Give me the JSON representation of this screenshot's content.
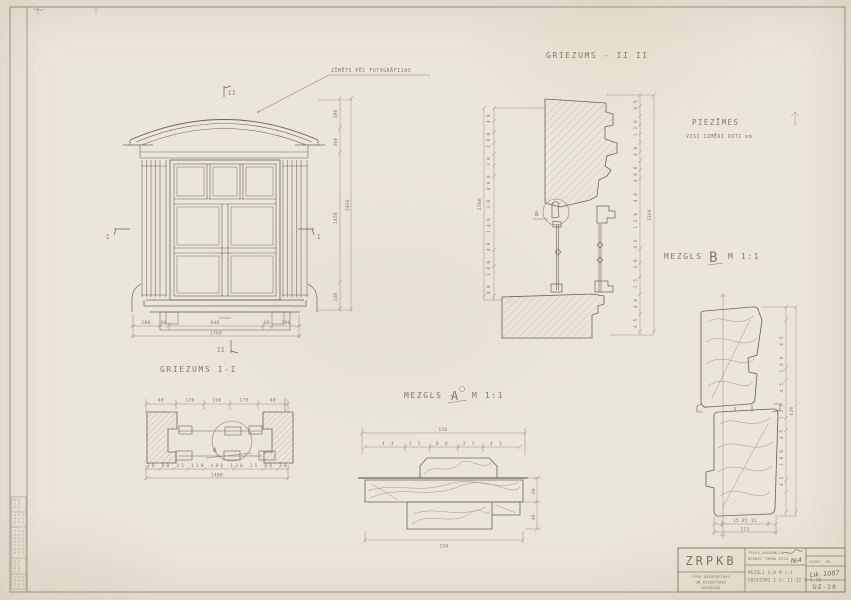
{
  "colors": {
    "paper": "#eae6d9",
    "pencil": "#837a6a",
    "line_dark": "#6b655a",
    "line_light": "#978e7c"
  },
  "notes": {
    "title": "PIEZĪMES",
    "line1": "VISI IZMĒRI DOTI mm"
  },
  "callout_note": "ZĪMĒTS PĒC FOTOGRĀFIJAS",
  "titles": {
    "section2": "GRIEZUMS - II II",
    "section1": "GRIEZUMS I-I",
    "detailA_prefix": "MEZGLS -",
    "detailA_letter": "A",
    "detailA_scale": "M 1:1",
    "detailB_prefix": "MEZGLS -",
    "detailB_letter": "B",
    "detailB_scale": "M 1:1"
  },
  "marks": {
    "sec2_top": "II",
    "sec2_bottom": "II",
    "sec1_left": "I",
    "sec1_right": "I",
    "calloutA": "A",
    "calloutB": "B"
  },
  "dims": {
    "win_bottom": [
      "280",
      "60",
      "840",
      "60",
      "280"
    ],
    "win_bottom_total": "1760",
    "win_right": [
      "380",
      "300",
      "1450",
      "330"
    ],
    "win_right_total": "2460",
    "s1_top": [
      "40",
      "170",
      "160",
      "170",
      "40"
    ],
    "s1_bottom": [
      "30",
      "80",
      "25",
      "130",
      "480",
      "130",
      "25",
      "80",
      "30"
    ],
    "s1_bottom_total": "1400",
    "a_top_total": "150",
    "a_row": [
      "43",
      "25",
      "80",
      "25",
      "43"
    ],
    "a_right": [
      "60",
      "40"
    ],
    "a_bottom_total": "150",
    "s2_left": [
      "40",
      "180",
      "40",
      "140",
      "30",
      "480",
      "30",
      "180",
      "40"
    ],
    "s2_left_total": "2300",
    "s2_right": [
      "45",
      "40",
      "15",
      "30",
      "40",
      "120",
      "40",
      "480",
      "40",
      "120",
      "45"
    ],
    "s2_right_total": "2300",
    "b_right": [
      "45",
      "160",
      "45",
      "120",
      "45",
      "160",
      "45"
    ],
    "b_right_total": "620",
    "b_bottom": [
      "15",
      "85",
      "15"
    ],
    "b_bottom_total": "115"
  },
  "titleblock": {
    "code": "ZRPKB",
    "project_line1": "TELPU ANSAMBLIS",
    "project_line2": "DEKORI TORŅA IELĀ",
    "project_no": "№4",
    "content_line1": "MEZGLI A;B M 1:1",
    "content_line2": "GRIEZUMI I-I; II-II M 1:10",
    "org_line1": "LPSR DĀRZKOPĪBAS",
    "org_line2": "UN BIŠKOPĪBAS",
    "org_line3": "BIEDRĪBA",
    "order_label": "PASŪT. NR.",
    "order_no": "Lik. 1087",
    "sheet_no": "UZ-20"
  }
}
